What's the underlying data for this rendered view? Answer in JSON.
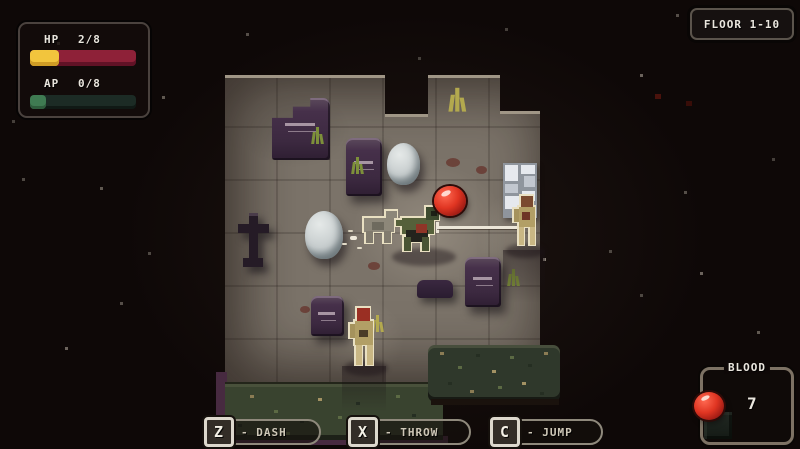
{
  "hud": {
    "stats": {
      "hp_label": "HP",
      "hp_value": "2/8",
      "hp_fill_pct": 27,
      "ap_label": "AP",
      "ap_value": "0/8",
      "ap_fill_pct": 15
    },
    "floor_badge": {
      "label": "FLOOR 1-10"
    },
    "blood": {
      "title": "BLOOD",
      "count": "7"
    },
    "hints": [
      {
        "key": "Z",
        "label": "- DASH"
      },
      {
        "key": "X",
        "label": "- THROW"
      },
      {
        "key": "C",
        "label": "- JUMP"
      }
    ]
  },
  "colors": {
    "background": "#0e0807",
    "floor": "#7b7369",
    "grass": "#333d2c",
    "tombstone": "#46304a",
    "hp_fill": "#f2c53d",
    "hp_bar": "#8e2138",
    "ap_fill": "#3f7b52",
    "ap_bar": "#1c2b25",
    "blood_orb": "#d9291b"
  },
  "scene": {
    "map_kind": "graveyard-floor",
    "entities": {
      "player": 1,
      "dash_ghost": 1,
      "spear": 1,
      "blood_orb": 1,
      "zombies": 2,
      "tombstones": 5,
      "egg_boulders": 2,
      "cross_statue": 1,
      "maze_tile": 1,
      "grass_patches": 2,
      "grass_tufts": 5,
      "blood_splats": 4
    }
  }
}
